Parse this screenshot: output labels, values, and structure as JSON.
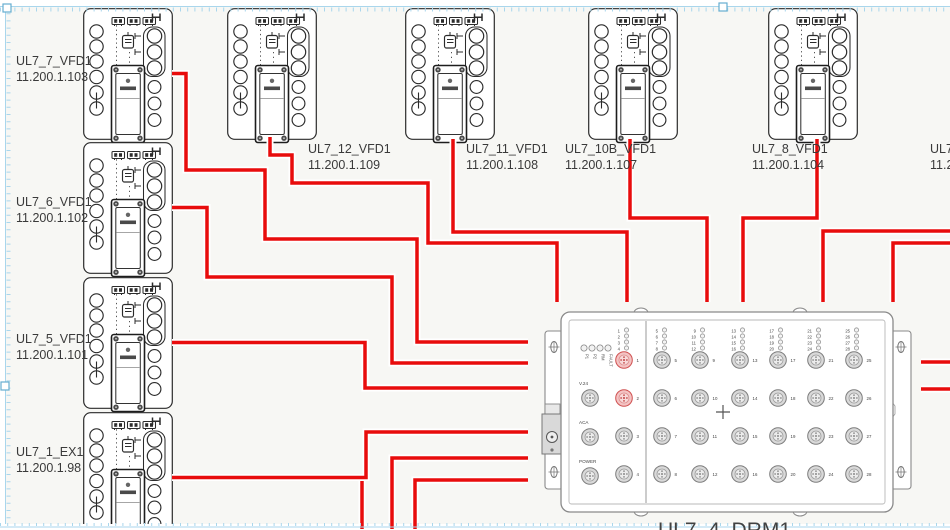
{
  "colors": {
    "canvas_bg": "#f7f7f4",
    "wire": "#e80c0c",
    "wire_casing": "#ffffff",
    "device_stroke": "#2b2b2b",
    "drm_stroke": "#8a8a8a",
    "label_text": "#3a3a3a",
    "selection": "#a9d6ec",
    "handle_stroke": "#66aed0",
    "port_red_fill": "#f4c3c3",
    "port_red_stroke": "#cf5050"
  },
  "devices": [
    {
      "name": "UL7_7_VFD1",
      "ip": "11.200.1.103",
      "x": 83,
      "y": 8,
      "label_x": 16,
      "label_y": 53
    },
    {
      "name": "UL7_6_VFD1",
      "ip": "11.200.1.102",
      "x": 83,
      "y": 142,
      "label_x": 16,
      "label_y": 194
    },
    {
      "name": "UL7_5_VFD1",
      "ip": "11.200.1.101",
      "x": 83,
      "y": 277,
      "label_x": 16,
      "label_y": 331
    },
    {
      "name": "UL7_1_EX1",
      "ip": "11.200.1.98",
      "x": 83,
      "y": 412,
      "label_x": 16,
      "label_y": 444
    },
    {
      "name": "UL7_12_VFD1",
      "ip": "11.200.1.109",
      "x": 227,
      "y": 8,
      "label_x": 308,
      "label_y": 141
    },
    {
      "name": "UL7_11_VFD1",
      "ip": "11.200.1.108",
      "x": 405,
      "y": 8,
      "label_x": 466,
      "label_y": 141
    },
    {
      "name": "UL7_10B_VFD1",
      "ip": "11.200.1.107",
      "x": 588,
      "y": 8,
      "label_x": 565,
      "label_y": 141
    },
    {
      "name": "UL7_8_VFD1",
      "ip": "11.200.1.104",
      "x": 768,
      "y": 8,
      "label_x": 752,
      "label_y": 141
    },
    {
      "name": "UL7_",
      "ip": "11.2",
      "x": 1005,
      "y": 8,
      "label_x": 930,
      "label_y": 141
    }
  ],
  "drm": {
    "label": "UL7_4_DRM1",
    "x": 561,
    "y": 312,
    "width": 332,
    "height": 200,
    "label_x": 658,
    "label_y": 537,
    "port_count": 28,
    "red_ports": [
      1,
      2
    ],
    "port_cols": [
      624,
      662,
      700,
      740,
      778,
      816,
      854
    ],
    "port_rows": [
      360,
      398,
      436,
      474
    ],
    "divider_x": 646,
    "connector_labels": [
      "V.24",
      "ACA",
      "POWER"
    ],
    "status_led_labels": [
      "P1",
      "P2",
      "RM",
      "FAULT"
    ]
  },
  "wires": [
    {
      "name": "wire-bottom-branch",
      "points": [
        [
          362,
          477.5
        ],
        [
          362,
          529
        ]
      ]
    },
    {
      "name": "wire-ul7-7-vfd1-drm",
      "points": [
        [
          172,
          73.5
        ],
        [
          186,
          73.5
        ],
        [
          186,
          170
        ],
        [
          265,
          170
        ],
        [
          265,
          239
        ],
        [
          417,
          239
        ],
        [
          417,
          342
        ],
        [
          528,
          342
        ]
      ]
    },
    {
      "name": "wire-ul7-6-vfd1-drm",
      "points": [
        [
          172,
          207.5
        ],
        [
          207,
          207.5
        ],
        [
          207,
          277
        ],
        [
          392,
          277
        ],
        [
          392,
          363
        ],
        [
          528,
          363
        ]
      ]
    },
    {
      "name": "wire-ul7-5-vfd1-drm",
      "points": [
        [
          172,
          342.5
        ],
        [
          365,
          342.5
        ],
        [
          365,
          388
        ],
        [
          528,
          388
        ]
      ]
    },
    {
      "name": "wire-ul7-1-ex1-drm",
      "points": [
        [
          172,
          477.5
        ],
        [
          366,
          477.5
        ],
        [
          366,
          432
        ],
        [
          528,
          432
        ]
      ]
    },
    {
      "name": "wire-bottom-1-drm",
      "points": [
        [
          392,
          529
        ],
        [
          392,
          458
        ],
        [
          528,
          458
        ]
      ]
    },
    {
      "name": "wire-bottom-2-drm",
      "points": [
        [
          415,
          529
        ],
        [
          415,
          480
        ],
        [
          528,
          480
        ]
      ]
    },
    {
      "name": "wire-ul7-12-vfd1-drm",
      "points": [
        [
          270,
          137
        ],
        [
          270,
          155
        ],
        [
          292,
          155
        ],
        [
          292,
          183
        ],
        [
          428,
          183
        ],
        [
          428,
          243
        ],
        [
          557,
          243
        ],
        [
          557,
          302
        ]
      ]
    },
    {
      "name": "wire-ul7-11-vfd1-drm",
      "points": [
        [
          453,
          139
        ],
        [
          453,
          232
        ],
        [
          627,
          232
        ],
        [
          627,
          302
        ]
      ]
    },
    {
      "name": "wire-ul7-10b-vfd1-drm",
      "points": [
        [
          630,
          139
        ],
        [
          630,
          218
        ],
        [
          707,
          218
        ],
        [
          707,
          302
        ]
      ]
    },
    {
      "name": "wire-ul7-8-vfd1-drm",
      "points": [
        [
          817,
          139
        ],
        [
          817,
          218
        ],
        [
          743,
          218
        ],
        [
          743,
          302
        ]
      ]
    },
    {
      "name": "wire-right-1-drm",
      "points": [
        [
          950,
          231
        ],
        [
          823,
          231
        ],
        [
          823,
          302
        ]
      ]
    },
    {
      "name": "wire-right-2-drm",
      "points": [
        [
          950,
          243
        ],
        [
          893,
          243
        ],
        [
          893,
          302
        ]
      ]
    },
    {
      "name": "wire-drm-right-a",
      "points": [
        [
          950,
          362
        ],
        [
          921,
          362
        ]
      ]
    },
    {
      "name": "wire-drm-right-b",
      "points": [
        [
          950,
          389
        ],
        [
          921,
          389
        ]
      ]
    }
  ],
  "handles": [
    [
      3,
      4
    ],
    [
      719,
      3
    ],
    [
      1,
      382
    ]
  ]
}
